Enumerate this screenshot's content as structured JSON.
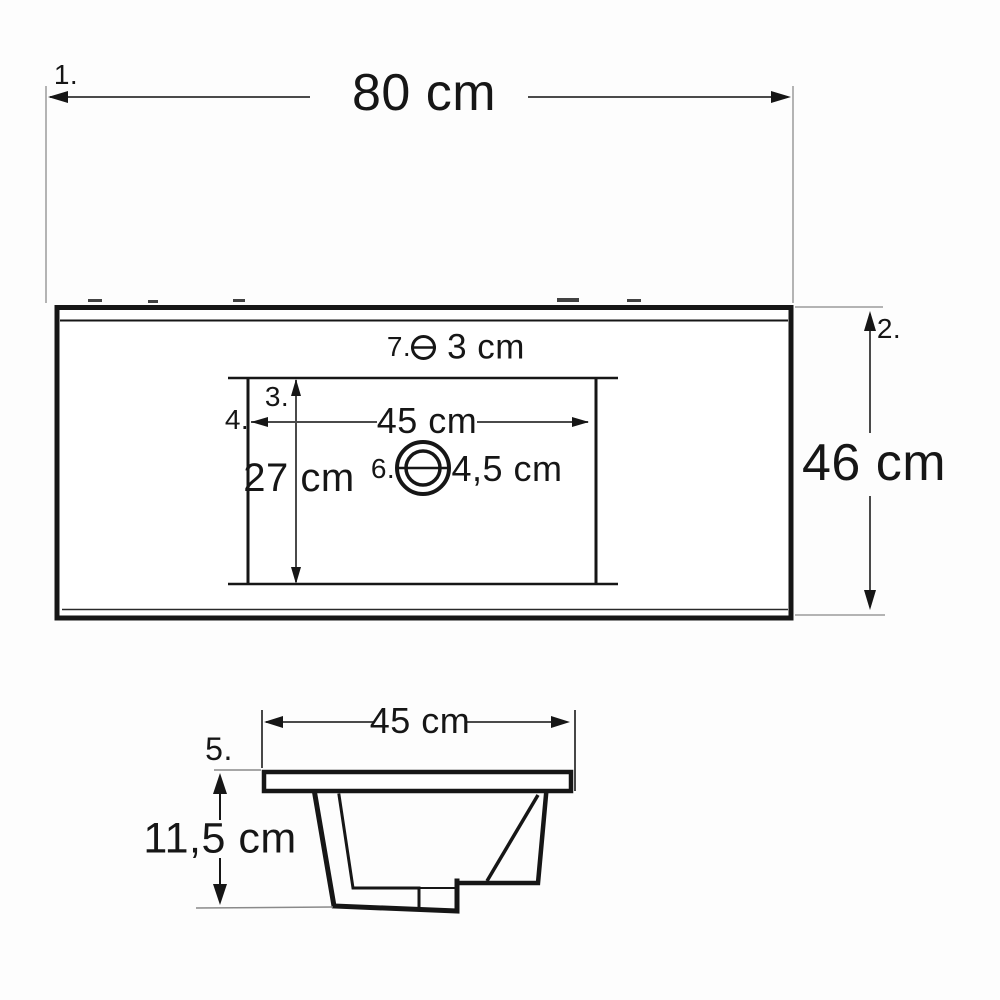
{
  "diagram_type": "washbasin technical dimension drawing",
  "colors": {
    "main_line": "#161616",
    "dimension_line": "#4a4a4a",
    "extension_line": "#9c9c9c",
    "text": "#161616",
    "background": "#fdfdfd"
  },
  "top_view": {
    "name": "washbasin top view",
    "overall_width": {
      "ref": "1.",
      "value": "80 cm"
    },
    "overall_depth": {
      "ref": "2.",
      "value": "46 cm"
    },
    "basin_inner_depth": {
      "ref": "3.",
      "value": "27 cm"
    },
    "basin_inner_width": {
      "ref": "4.",
      "value": "45 cm"
    },
    "drain_hole": {
      "ref": "6.",
      "value": "4,5 cm"
    },
    "faucet_hole": {
      "ref": "7.",
      "value": "3 cm"
    }
  },
  "section_view": {
    "name": "washbasin cross-section view",
    "rim": {
      "ref": "5."
    },
    "basin_top_width": {
      "value": "45 cm"
    },
    "basin_depth": {
      "value": "11,5 cm"
    }
  }
}
